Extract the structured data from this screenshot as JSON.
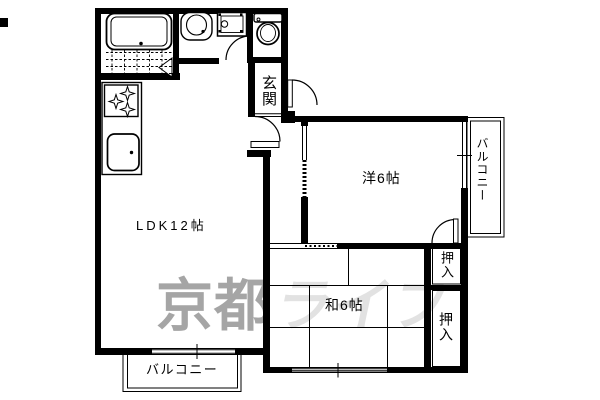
{
  "labels": {
    "ldk": "LDK12帖",
    "western_room": "洋6帖",
    "japanese_room": "和6帖",
    "entrance": "玄関",
    "closet_upper": "押入",
    "closet_lower": "押入",
    "balcony_right": "バルコニー",
    "balcony_bottom": "バルコニー"
  },
  "watermark": {
    "text_dark": "京都",
    "text_light": "ライフ",
    "dark_color": "#a5a5a5",
    "light_color": "#e2e2e2"
  },
  "colors": {
    "wall": "#000000",
    "background": "#ffffff",
    "line": "#000000"
  },
  "icons": [
    "bathtub-icon",
    "bath-tile-floor",
    "folding-door-icon",
    "washbasin-icon",
    "washing-machine-pan-icon",
    "toilet-icon",
    "gas-stove-icon",
    "kitchen-counter",
    "kitchen-sink-icon",
    "door-swing-arc",
    "window-symbol",
    "tatami-grid",
    "balcony-rail"
  ]
}
